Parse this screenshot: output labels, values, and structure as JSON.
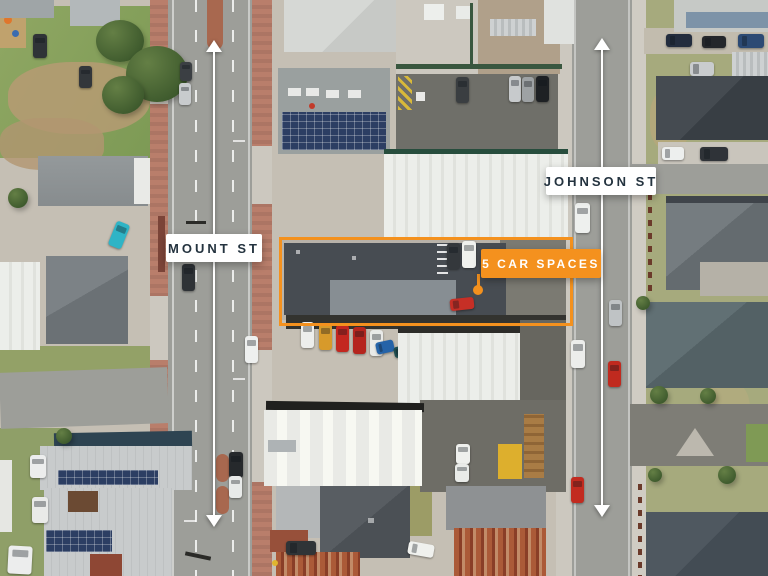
{
  "labels": {
    "mount_st": "MOUNT ST",
    "johnson_st": "JOHNSON ST"
  },
  "callout": {
    "car_spaces": "5 CAR SPACES"
  },
  "colors": {
    "accent_orange": "#F4911E",
    "label_background": "#FFFFFF",
    "label_text": "#24333F",
    "arrow_white": "#FFFFFF"
  }
}
